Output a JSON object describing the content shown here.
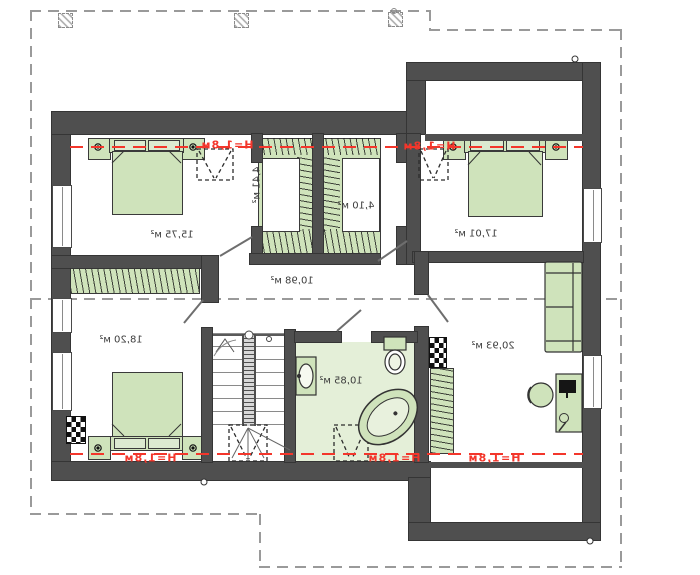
{
  "colors": {
    "wall": "#4f4f4f",
    "furniture_green": "#cfe3bb",
    "bath_floor_green": "#e4efd8",
    "accent_red": "#f3362b",
    "roof_outline_gray": "#9a9a9a"
  },
  "note": "all plan text is mirrored (horizontally flipped drawing)",
  "rooms": {
    "bedroom_top_left": "15,75 м²",
    "closet_left": "4,41 м²",
    "closet_right": "4,10 м²",
    "bedroom_top_right": "17,01 м²",
    "hallway": "10,98 м²",
    "bedroom_bottom_left": "18,20 м²",
    "bathroom": "10,85 м²",
    "room_bottom_right": "20,93 м²"
  },
  "height_mark_label": "H=1,8м"
}
